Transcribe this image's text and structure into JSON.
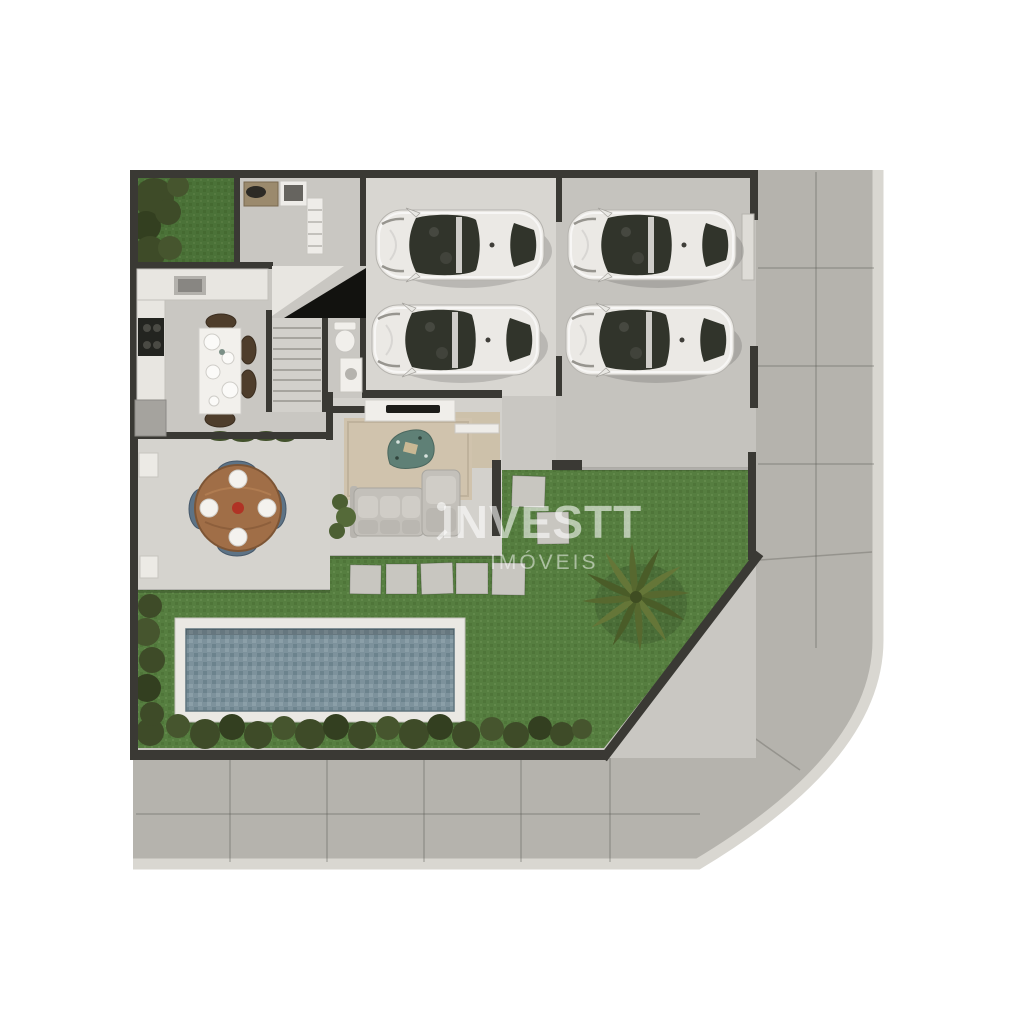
{
  "watermark": {
    "brand": "INVESTT",
    "subtitle": "IMÓVEIS"
  },
  "scene": {
    "type": "top-down architectural render of a house ground floor and lot",
    "cars_count": 4,
    "elements": [
      "garage with two cars",
      "driveway with two cars",
      "kitchen with island table",
      "staircase",
      "powder room",
      "living room with sofa and tv console",
      "covered terrace with round dining table",
      "garden patch",
      "lawn",
      "swimming pool",
      "hedge row",
      "palm tree",
      "stepping stones",
      "corner sidewalk"
    ]
  },
  "colors": {
    "page_bg": "#ffffff",
    "sidewalk": "#b5b3ad",
    "curb": "#d9d7d1",
    "concrete": "#c9c7c2",
    "garage_floor": "#d8d6d1",
    "driveway": "#c5c3be",
    "terrace_floor": "#d5d3ce",
    "living_floor": "#d3d1cc",
    "entry_wood": "#cdc1aa",
    "wall": "#3a3934",
    "lawn": "#567e40",
    "lawn_dark": "#4b7136",
    "hedge": "#3e4b28",
    "pool_deck": "#eae8e3",
    "pool_water": "#7d929c",
    "car_body": "#ebe9e5",
    "car_glass": "#31342b",
    "wood": "#a06e47",
    "chair_blue": "#5d7386",
    "rug": "#d0c3ad",
    "accent_rug": "#5f8076",
    "watermark": "rgba(255,255,255,0.58)",
    "watermark_sub": "rgba(255,255,255,0.50)"
  }
}
